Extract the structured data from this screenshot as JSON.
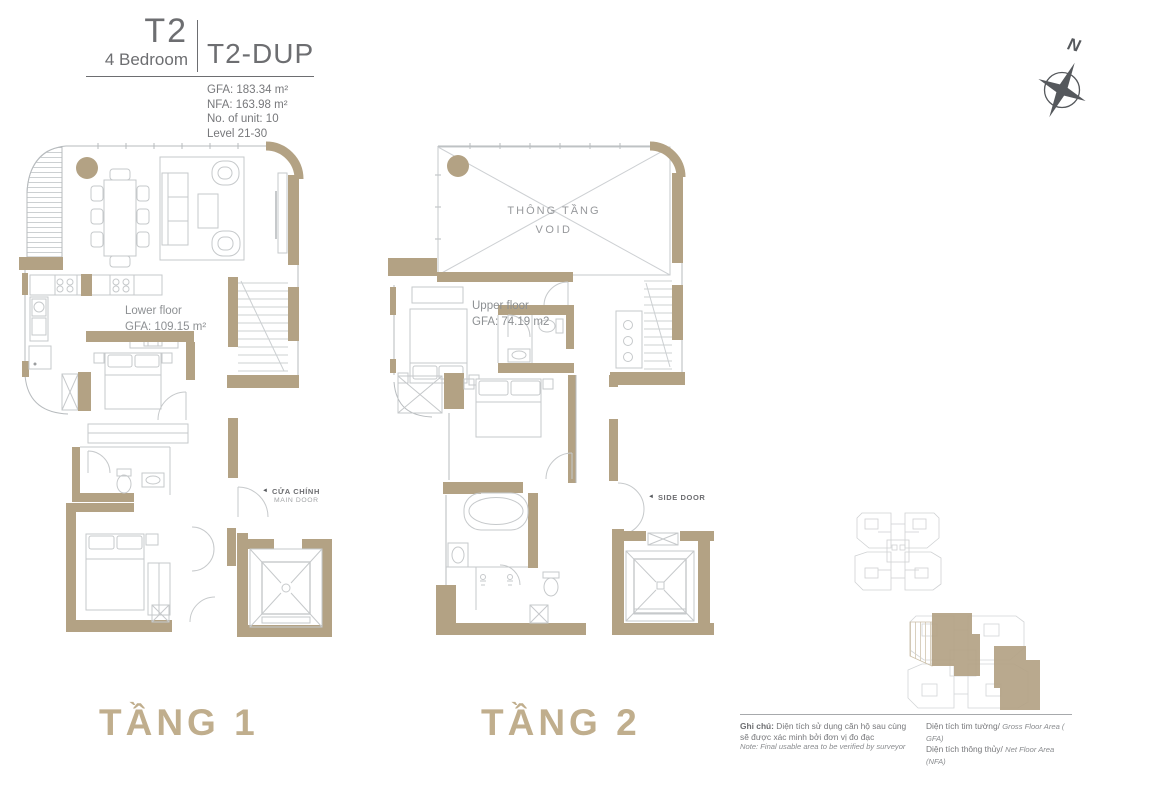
{
  "colors": {
    "wall_tan": "#b3a284",
    "label_tan": "#c0ae8d",
    "text_gray": "#6d6e71",
    "furniture_gray": "#c6c9cb"
  },
  "title_block": {
    "code": "T2",
    "type": "4 Bedroom",
    "variant": "T2-DUP",
    "gfa": "GFA: 183.34 m²",
    "nfa": "NFA: 163.98 m²",
    "units": "No. of unit: 10",
    "level": "Level 21-30"
  },
  "compass": {
    "label": "N"
  },
  "floor1": {
    "label": "TẦNG 1",
    "area_title": "Lower floor",
    "area_value": "GFA: 109.15 m²",
    "door_arrow": "◄",
    "door_vi": "CỬA CHÍNH",
    "door_en": "MAIN DOOR"
  },
  "floor2": {
    "label": "TẦNG 2",
    "area_title": "Upper floor",
    "area_value": "GFA: 74.19 m2",
    "void_vi": "THÔNG TẦNG",
    "void_en": "VOID",
    "door_arrow": "◄",
    "side_door": "SIDE DOOR"
  },
  "legend": {
    "note_label": "Ghi chú:",
    "note_vi_1": "Diện tích sử dụng căn hộ sau cùng",
    "note_vi_2": "sẽ được xác minh bởi đơn vị đo đạc",
    "note_en": "Note: Final usable area to be verified by surveyor",
    "gfa_vi": "Diện tích tim tường/",
    "gfa_en": "Gross Floor Area ( GFA)",
    "nfa_vi": "Diện tích thông thủy/",
    "nfa_en": "Net Floor Area (NFA)"
  }
}
